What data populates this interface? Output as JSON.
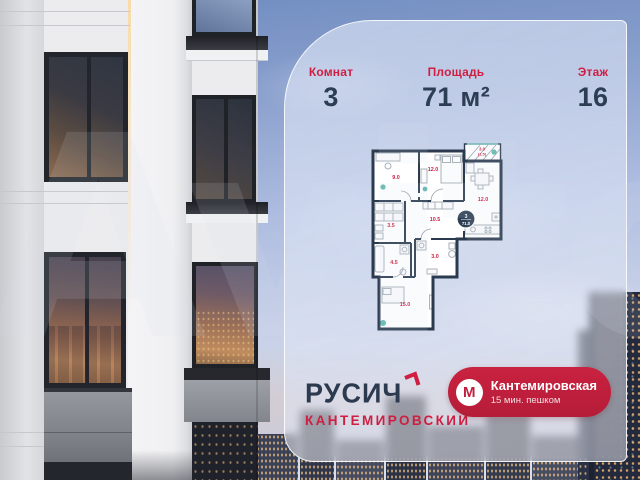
{
  "listing": {
    "stats": [
      {
        "label": "Комнат",
        "value": "3"
      },
      {
        "label": "Площадь",
        "value": "71 м²"
      },
      {
        "label": "Этаж",
        "value": "16"
      }
    ]
  },
  "floorplan": {
    "badge": {
      "rooms": "3",
      "area": "71.0"
    },
    "rooms": [
      {
        "name": "bedroom",
        "area": "9.0"
      },
      {
        "name": "bedroom-2",
        "area": "12.0"
      },
      {
        "name": "balcony",
        "area": "3.0",
        "area_coef": "(1.5)"
      },
      {
        "name": "kitchen-living",
        "area": "12.0"
      },
      {
        "name": "hallway",
        "area": "10.5"
      },
      {
        "name": "wardrobe",
        "area": "3.5"
      },
      {
        "name": "bathroom",
        "area": "3.0"
      },
      {
        "name": "bathroom-2",
        "area": "4.5"
      },
      {
        "name": "living-room",
        "area": "15.0"
      }
    ]
  },
  "brand": {
    "name": "РУСИЧ",
    "project": "КАНТЕМИРОВСКИЙ"
  },
  "metro": {
    "logo": "М",
    "station": "Кантемировская",
    "distance": "15 мин. пешком"
  },
  "watermark": "Avito",
  "colors": {
    "accent_red": "#cf1e41",
    "navy": "#2c3e53",
    "metro_red": "#c11f3e"
  }
}
